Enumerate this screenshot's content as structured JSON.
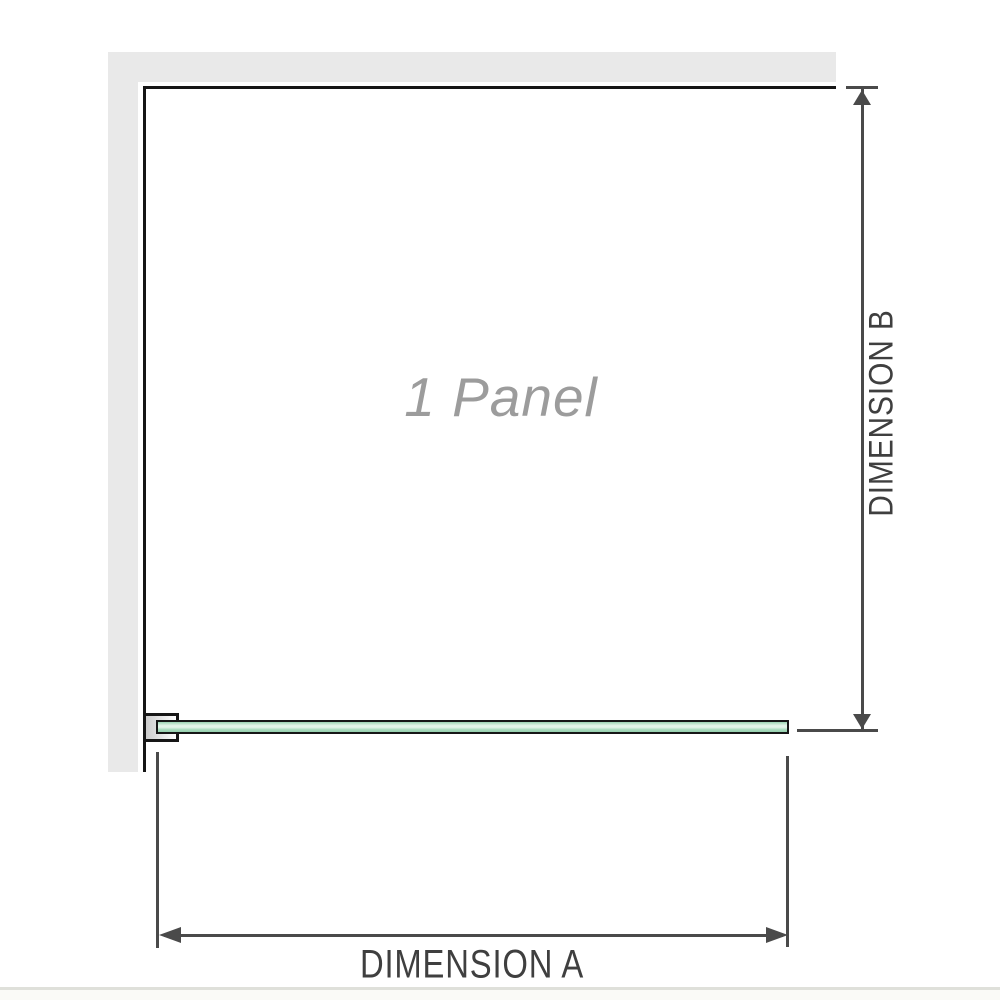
{
  "diagram": {
    "panel_label": "1 Panel",
    "dimension_a_label": "DIMENSION A",
    "dimension_b_label": "DIMENSION B"
  },
  "colors": {
    "wall": "#e9e9e9",
    "outline": "#161616",
    "dimension_line": "#4a4a4a",
    "label_text": "#3f3f3f",
    "panel_text": "#9c9c9c",
    "glass_green": "#9ad2b2",
    "glass_highlight": "#e6f5ea"
  }
}
